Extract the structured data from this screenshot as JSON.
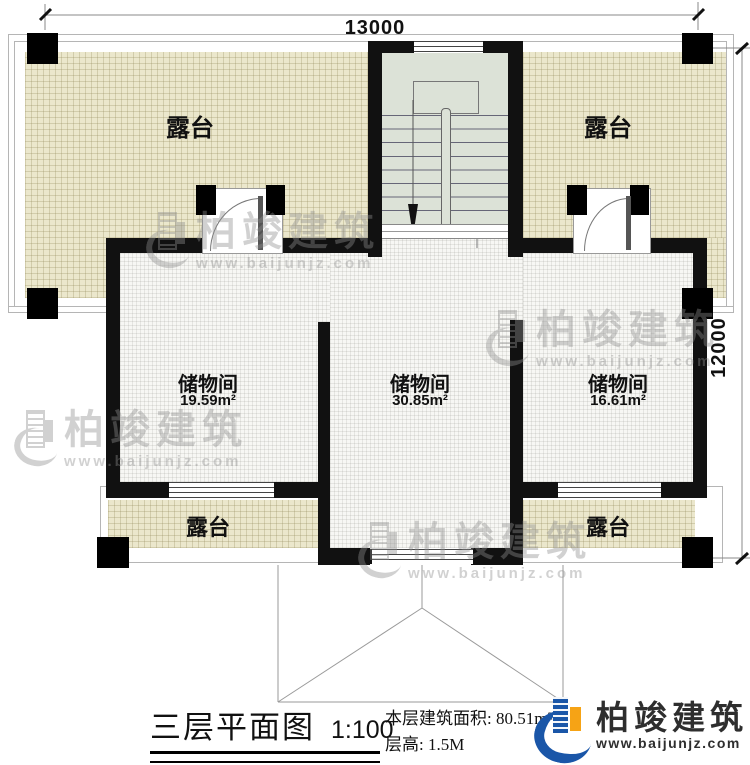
{
  "plan": {
    "dimensions": {
      "top_width": "13000",
      "right_height": "12000"
    },
    "terrace_top_left": {
      "label": "露台"
    },
    "terrace_top_right": {
      "label": "露台"
    },
    "storage_left": {
      "label": "储物间",
      "area": "19.59m²"
    },
    "storage_middle": {
      "label": "储物间",
      "area": "30.85m²"
    },
    "storage_right": {
      "label": "储物间",
      "area": "16.61m²"
    },
    "terrace_bottom_left": {
      "label": "露台"
    },
    "terrace_bottom_right": {
      "label": "露台"
    }
  },
  "watermark": {
    "name": "柏竣建筑",
    "url": "www.baijunjz.com"
  },
  "footer": {
    "title": "三层平面图",
    "scale": "1:100",
    "area_label": "本层建筑面积: 80.51m²",
    "floor_height_label": "层高: 1.5M",
    "brand_name": "柏竣建筑",
    "brand_url": "www.baijunjz.com"
  },
  "colors": {
    "wall": "#111111",
    "terrace_fill": "#ebe7cc",
    "stair_fill": "#dce2d7",
    "brand_blue": "#1a56a8",
    "brand_orange": "#f6a315"
  }
}
